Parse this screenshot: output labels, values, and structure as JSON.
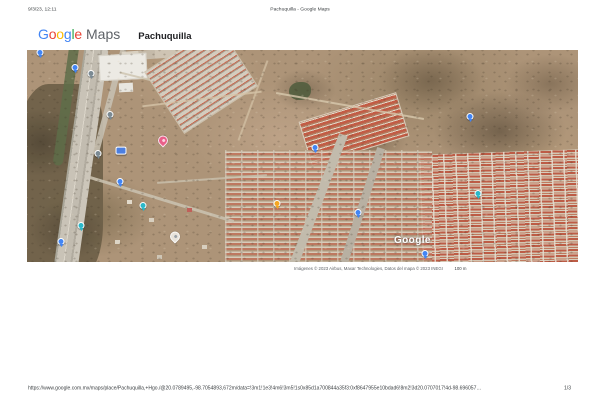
{
  "print_header": {
    "datetime": "9/3/23, 12:11",
    "document_title": "Pachuquilla - Google Maps"
  },
  "brand": {
    "logo_letters": [
      {
        "ch": "G",
        "color": "#4285F4"
      },
      {
        "ch": "o",
        "color": "#EA4335"
      },
      {
        "ch": "o",
        "color": "#FBBC05"
      },
      {
        "ch": "g",
        "color": "#4285F4"
      },
      {
        "ch": "l",
        "color": "#34A853"
      },
      {
        "ch": "e",
        "color": "#EA4335"
      }
    ],
    "logo_suffix": "Maps",
    "place_name": "Pachuquilla"
  },
  "map": {
    "type": "satellite",
    "watermark": "Google",
    "attribution": "Imágenes © 2023 Airbus, Maxar Technologies, Datos del mapa © 2023 INEGI",
    "scale_label": "100 m",
    "markers": [
      {
        "name": "blue-poi-marker",
        "type": "circle",
        "color": "#4285f4",
        "x": 13,
        "y": 4
      },
      {
        "name": "blue-poi-marker",
        "type": "circle",
        "color": "#4285f4",
        "x": 48,
        "y": 19
      },
      {
        "name": "gray-poi-marker",
        "type": "circle",
        "color": "#7b8a93",
        "x": 64,
        "y": 25
      },
      {
        "name": "gray-poi-marker",
        "type": "circle",
        "color": "#7b8a93",
        "x": 83,
        "y": 66
      },
      {
        "name": "gray-poi-marker",
        "type": "circle",
        "color": "#7b8a93",
        "x": 71,
        "y": 105
      },
      {
        "name": "road-shield",
        "type": "shield",
        "color": "#4d7fe0",
        "x": 94,
        "y": 101
      },
      {
        "name": "blue-poi-marker",
        "type": "circle",
        "color": "#4285f4",
        "x": 93,
        "y": 133
      },
      {
        "name": "teal-poi-marker",
        "type": "circle",
        "color": "#2bb8c9",
        "x": 116,
        "y": 157
      },
      {
        "name": "teal-poi-marker",
        "type": "circle",
        "color": "#2bb8c9",
        "x": 54,
        "y": 177
      },
      {
        "name": "blue-poi-marker",
        "type": "circle",
        "color": "#4285f4",
        "x": 34,
        "y": 193
      },
      {
        "name": "pink-place-pin",
        "type": "pin",
        "color": "#e9608a",
        "inner": "#fbd3e0",
        "x": 136,
        "y": 91
      },
      {
        "name": "white-place-pin",
        "type": "pin",
        "color": "#e8e3db",
        "inner": "#9aa0a6",
        "x": 148,
        "y": 187
      },
      {
        "name": "orange-poi-marker",
        "type": "circle",
        "color": "#f5a623",
        "x": 250,
        "y": 155
      },
      {
        "name": "blue-poi-marker",
        "type": "circle",
        "color": "#4285f4",
        "x": 331,
        "y": 164
      },
      {
        "name": "blue-poi-marker",
        "type": "circle",
        "color": "#4285f4",
        "x": 288,
        "y": 99
      },
      {
        "name": "blue-poi-marker",
        "type": "circle",
        "color": "#4285f4",
        "x": 443,
        "y": 68
      },
      {
        "name": "teal-poi-marker",
        "type": "circle",
        "color": "#2bb8c9",
        "x": 451,
        "y": 145
      },
      {
        "name": "blue-poi-marker",
        "type": "circle",
        "color": "#4285f4",
        "x": 398,
        "y": 205
      }
    ]
  },
  "print_footer": {
    "url": "https://www.google.com.mx/maps/place/Pachuquilla,+Hgo./@20.0789495,-98.7054893,672m/data=!3m1!1e3!4m6!3m5!1s0x85d1a700844a35f3:0xf8647955e10bdad6!8m2!3d20.0707017!4d-98.696057…",
    "page_indicator": "1/3"
  }
}
